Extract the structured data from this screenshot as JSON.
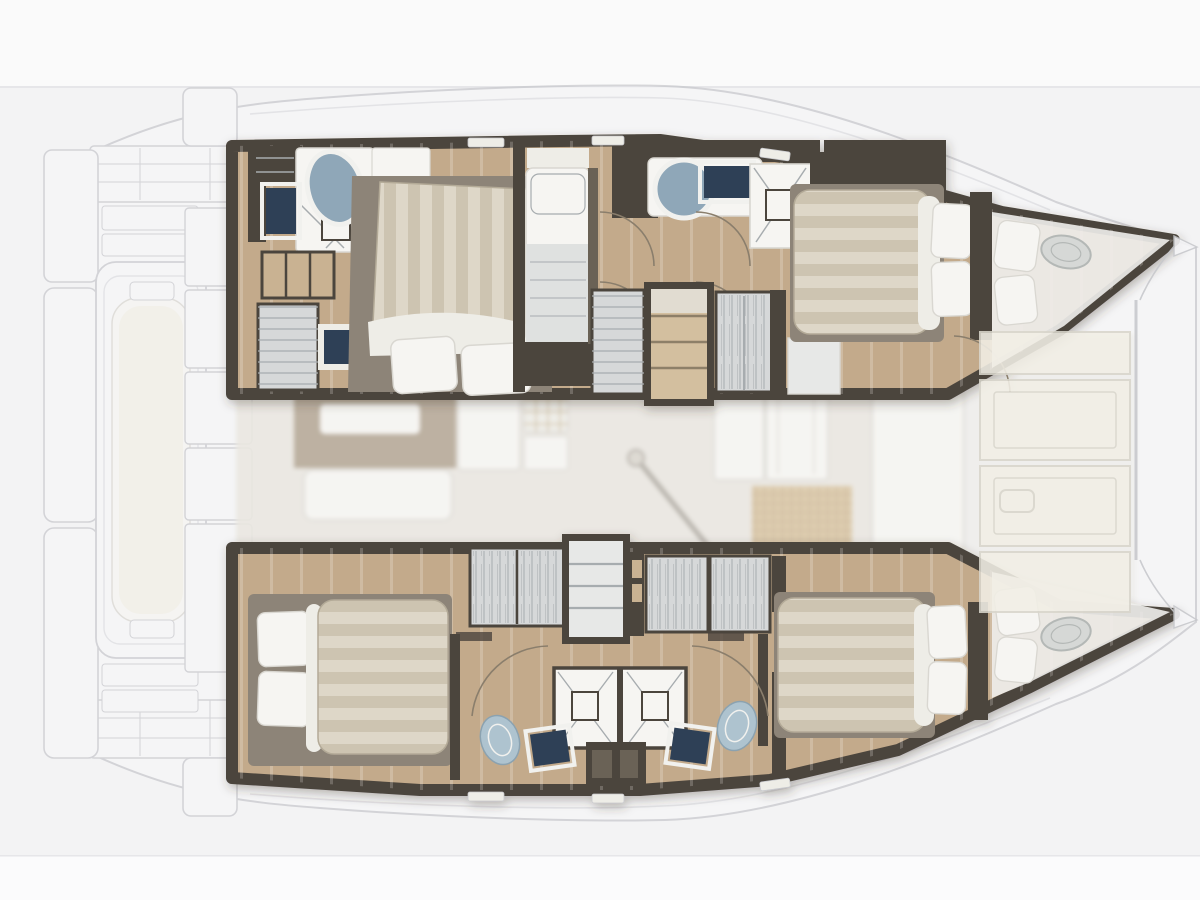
{
  "meta": {
    "type": "yacht-floor-plan",
    "subject": "Top-down interior layout plan of a sailing catamaran, bow to the right, overlaid on a faded deck plan",
    "visible_text": "none"
  },
  "colors": {
    "bg": "#f3f3f4",
    "bandTop": "#fafafa",
    "bandBot": "#fbfbfc",
    "edge": "#e6e6e9",
    "deckLine": "#c7c8cc",
    "deckInner": "#dddee1",
    "deckFill": "#f6f6f8",
    "cream": "#f2efe6",
    "creamLine": "#d9d6cc",
    "wall": "#4c453d",
    "wallMid": "#6b6257",
    "floor": "#c3aa8b",
    "tanShelf": "#c9b292",
    "duvet": "#ded7c8",
    "duvetStripe": "#cdc4b1",
    "pillow": "#f8f7f4",
    "white": "#f6f5f2",
    "offWhite": "#eeede7",
    "frameWhite": "#f1f1ee",
    "navy": "#2e4156",
    "basin": "#8fa7b8",
    "toilet": "#aec3cf",
    "toiletLine": "#8ba2b0",
    "greyUnit": "#d6d8d9",
    "greyLine": "#a7acaf",
    "treadTan": "#d3bf9f",
    "treadLine": "#8d7f68",
    "treadLight": "#e7e8e7",
    "saloonFloor": "#eae7e1",
    "tableTop": "#b7aa99",
    "mat": "#dcc9a9",
    "matLine": "#c8b595",
    "hatch": "#d6d8d6",
    "hatchLine": "#b4b8b6",
    "arc": "#8a7e6c",
    "bedPad": "#8d8478",
    "blanket": "#dfe1e0",
    "softLine": "#d9d7d1",
    "nacelle": "#efeeec"
  },
  "inventory": {
    "stern_label": "Aft platform with tender dinghy, transom steps and davits",
    "port_hull_label": "Port hull (top): aft cabin with en-suite head and shower, hanging lockers, single berth, mid head with basin, shower and toilet, companionway stairs, fore double cabin, forepeak berth and bow hatch",
    "starboard_hull_label": "Starboard hull (bottom): aft double cabin, companionway stairs, wardrobes, twin back-to-back heads with showers, basins and toilets, fore double cabin, forepeak berth and bow hatch",
    "saloon_label": "Bridgedeck saloon (faded): table, sofa, galley with stove, mast post, sideboard, woven mat, chart table, foredeck lockers",
    "fixtures": [
      "double-bed",
      "pillow",
      "wardrobe-hanging-locker",
      "shower",
      "washbasin",
      "toilet",
      "stairs",
      "bow-hatch",
      "dinghy",
      "door-swing-arc"
    ]
  }
}
